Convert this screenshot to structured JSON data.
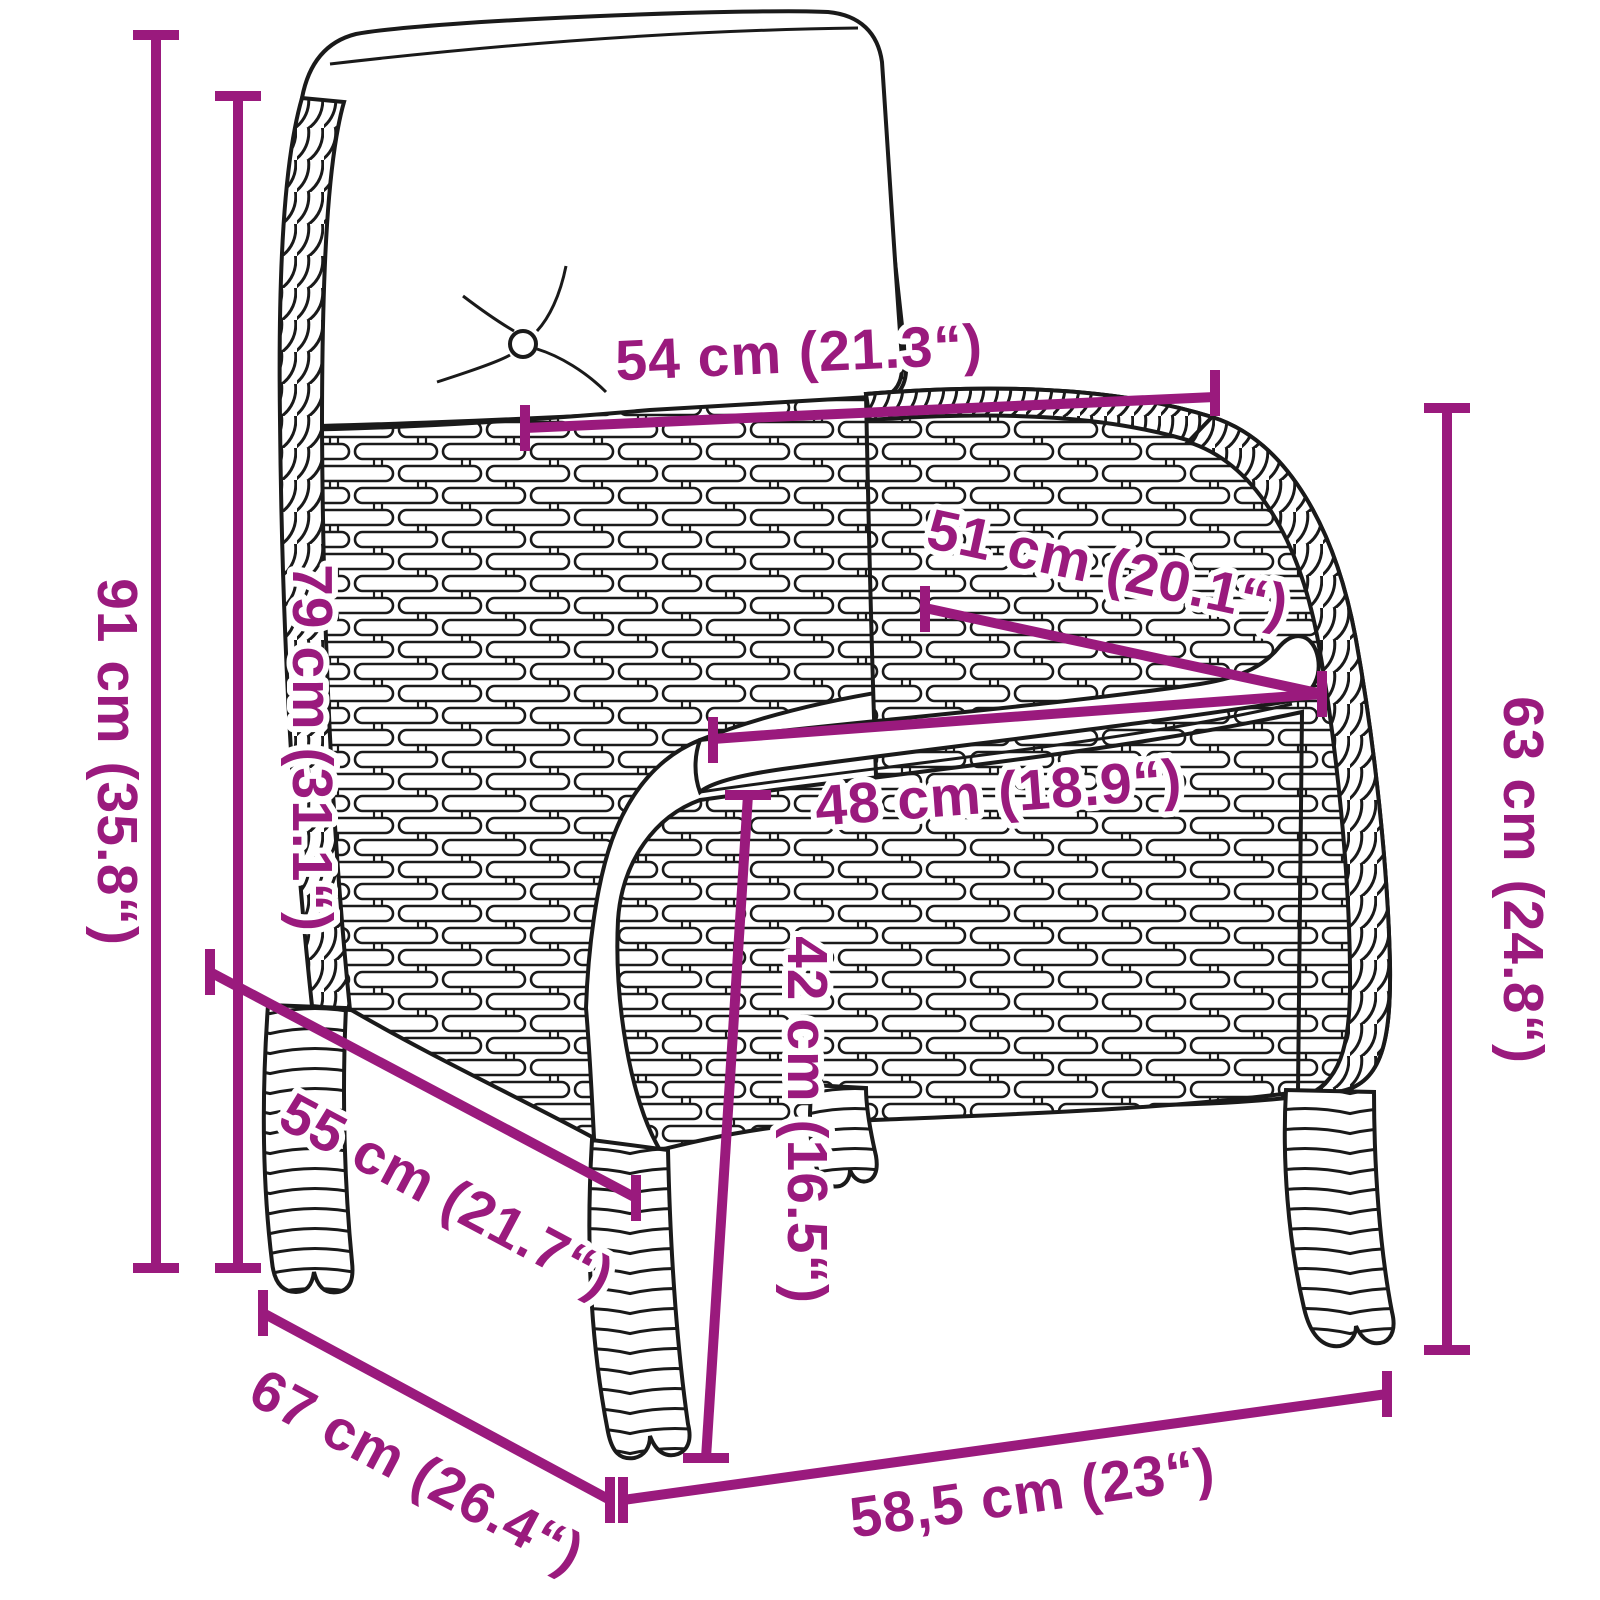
{
  "diagram": {
    "type": "product-dimension-diagram",
    "subject": "poly-rattan garden chair with seat and back cushions",
    "background_color": "#ffffff",
    "outline_color": "#1a1a1a",
    "accent_color": "#9a1a7d",
    "cushion_color": "#ffffff",
    "dimensions": [
      {
        "id": "total-height",
        "label": "91 cm (35.8“)"
      },
      {
        "id": "backrest-height",
        "label": "79 cm (31.1“)"
      },
      {
        "id": "back-cushion-width",
        "label": "54 cm (21.3“)"
      },
      {
        "id": "seat-depth",
        "label": "51 cm (20.1“)"
      },
      {
        "id": "seat-width",
        "label": "48 cm (18.9“)"
      },
      {
        "id": "armrest-height",
        "label": "63 cm (24.8“)"
      },
      {
        "id": "seat-height",
        "label": "42 cm (16.5“)"
      },
      {
        "id": "inner-depth",
        "label": "55 cm (21.7“)"
      },
      {
        "id": "total-depth",
        "label": "67 cm (26.4“)"
      },
      {
        "id": "front-width",
        "label": "58,5 cm (23“)"
      }
    ]
  }
}
